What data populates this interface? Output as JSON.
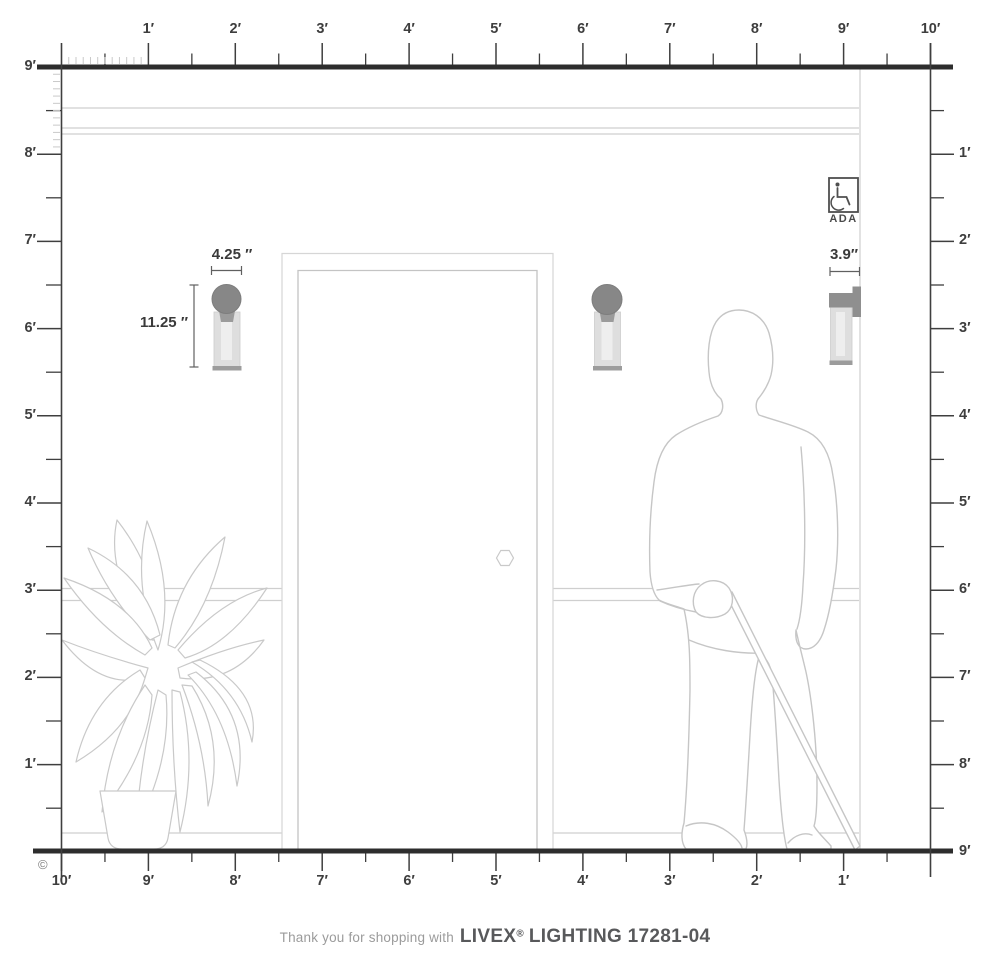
{
  "colors": {
    "heavy_line": "#2d2d2d",
    "ruler_ink": "#3f3f3f",
    "minor_tick": "#c9c9c9",
    "wall_line": "#cfcfcf",
    "sketch_line": "#c6c6c6",
    "fixture_metal": "#878787",
    "fixture_cap": "#9c9c9c",
    "fixture_glass": "#e3e3e3",
    "dimension_text": "#3a3a3a",
    "caption_gray": "#9b9b9b",
    "brand_dark": "#58595b"
  },
  "rulers": {
    "top_labels": [
      "1′",
      "2′",
      "3′",
      "4′",
      "5′",
      "6′",
      "7′",
      "8′",
      "9′",
      "10′"
    ],
    "bottom_labels": [
      "10′",
      "9′",
      "8′",
      "7′",
      "6′",
      "5′",
      "4′",
      "3′",
      "2′",
      "1′"
    ],
    "left_labels": [
      "9′",
      "8′",
      "7′",
      "6′",
      "5′",
      "4′",
      "3′",
      "2′",
      "1′"
    ],
    "right_labels": [
      "1′",
      "2′",
      "3′",
      "4′",
      "5′",
      "6′",
      "7′",
      "8′",
      "9′"
    ]
  },
  "fixture_dimensions": {
    "width": "4.25 ″",
    "height": "11.25 ″",
    "depth": "3.9″"
  },
  "ada_badge": {
    "label": "ADA"
  },
  "caption": {
    "prefix": "Thank you for shopping with",
    "brand": "LIVEX",
    "registered_mark": "®",
    "model": "LIGHTING 17281-04"
  },
  "copyright_symbol": "©"
}
